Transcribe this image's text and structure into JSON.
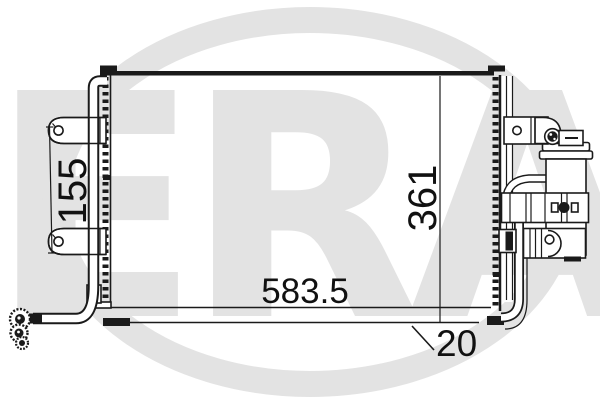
{
  "watermark": {
    "text": "ERA",
    "color": "#e3e3e3"
  },
  "drawing": {
    "line_color": "#1a1a1a",
    "background_color": "#ffffff",
    "dimensions": {
      "overall_width": "583.5",
      "overall_height": "361",
      "bracket_spacing": "155",
      "bottom_tank_depth": "20"
    }
  }
}
